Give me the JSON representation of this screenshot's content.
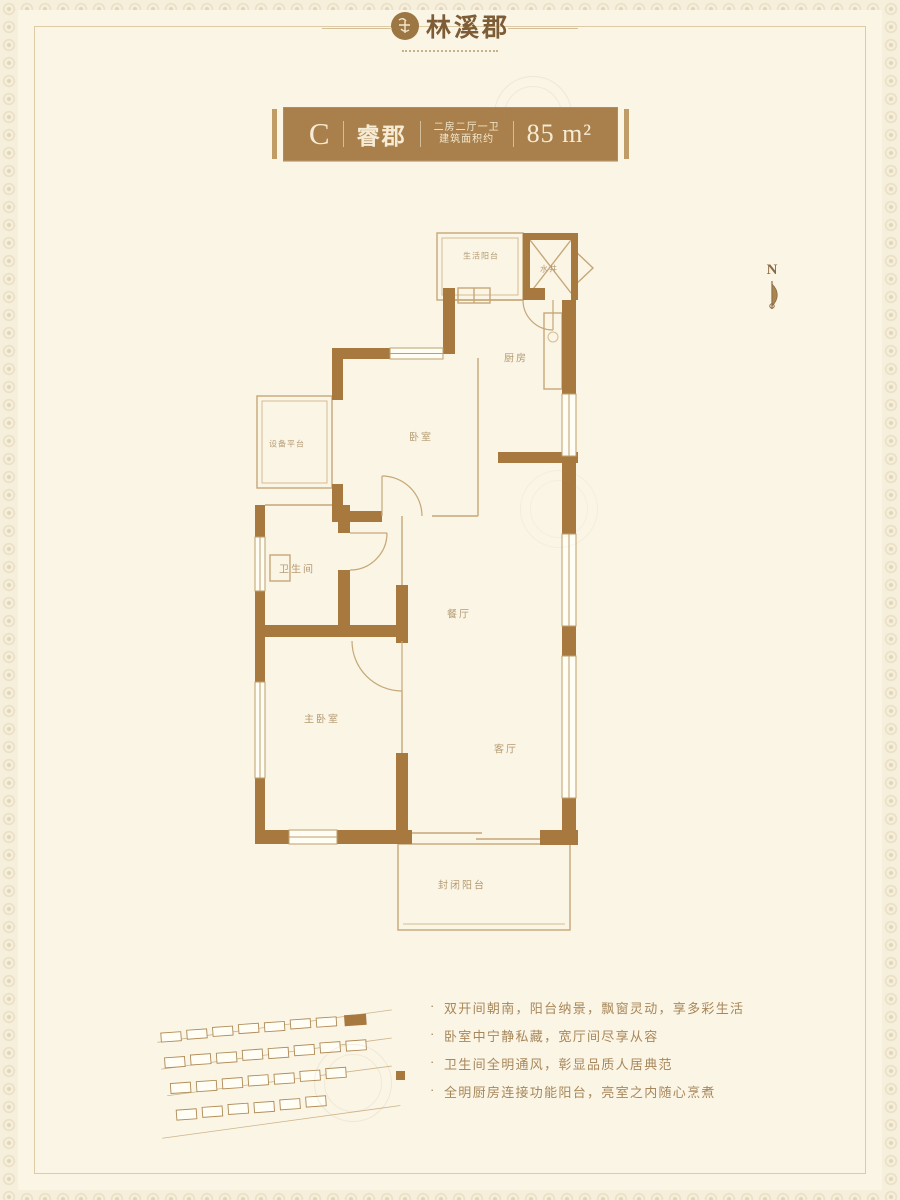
{
  "brand": {
    "name": "林溪郡"
  },
  "banner": {
    "unit": "C",
    "name": "睿郡",
    "spec_line1": "二房二厅一卫",
    "spec_line2": "建筑面积约",
    "area": "85 m²",
    "bg_color": "#A9804C"
  },
  "compass": {
    "label": "N"
  },
  "floor_plan": {
    "wall_color": "#A8793F",
    "rooms": [
      {
        "id": "life-balcony",
        "label": "生活阳台"
      },
      {
        "id": "utility-shaft",
        "label": "水井"
      },
      {
        "id": "kitchen",
        "label": "厨房"
      },
      {
        "id": "bedroom",
        "label": "卧室"
      },
      {
        "id": "equipment-platform",
        "label": "设备平台"
      },
      {
        "id": "bathroom",
        "label": "卫生间"
      },
      {
        "id": "dining-room",
        "label": "餐厅"
      },
      {
        "id": "master-bedroom",
        "label": "主卧室"
      },
      {
        "id": "living-room",
        "label": "客厅"
      },
      {
        "id": "enclosed-balcony",
        "label": "封闭阳台"
      }
    ]
  },
  "features": {
    "items": [
      "双开间朝南，阳台纳景，飘窗灵动，享多彩生活",
      "卧室中宁静私藏，宽厅间尽享从容",
      "卫生间全明通风，彰显品质人居典范",
      "全明厨房连接功能阳台，亮室之内随心烹煮"
    ]
  }
}
